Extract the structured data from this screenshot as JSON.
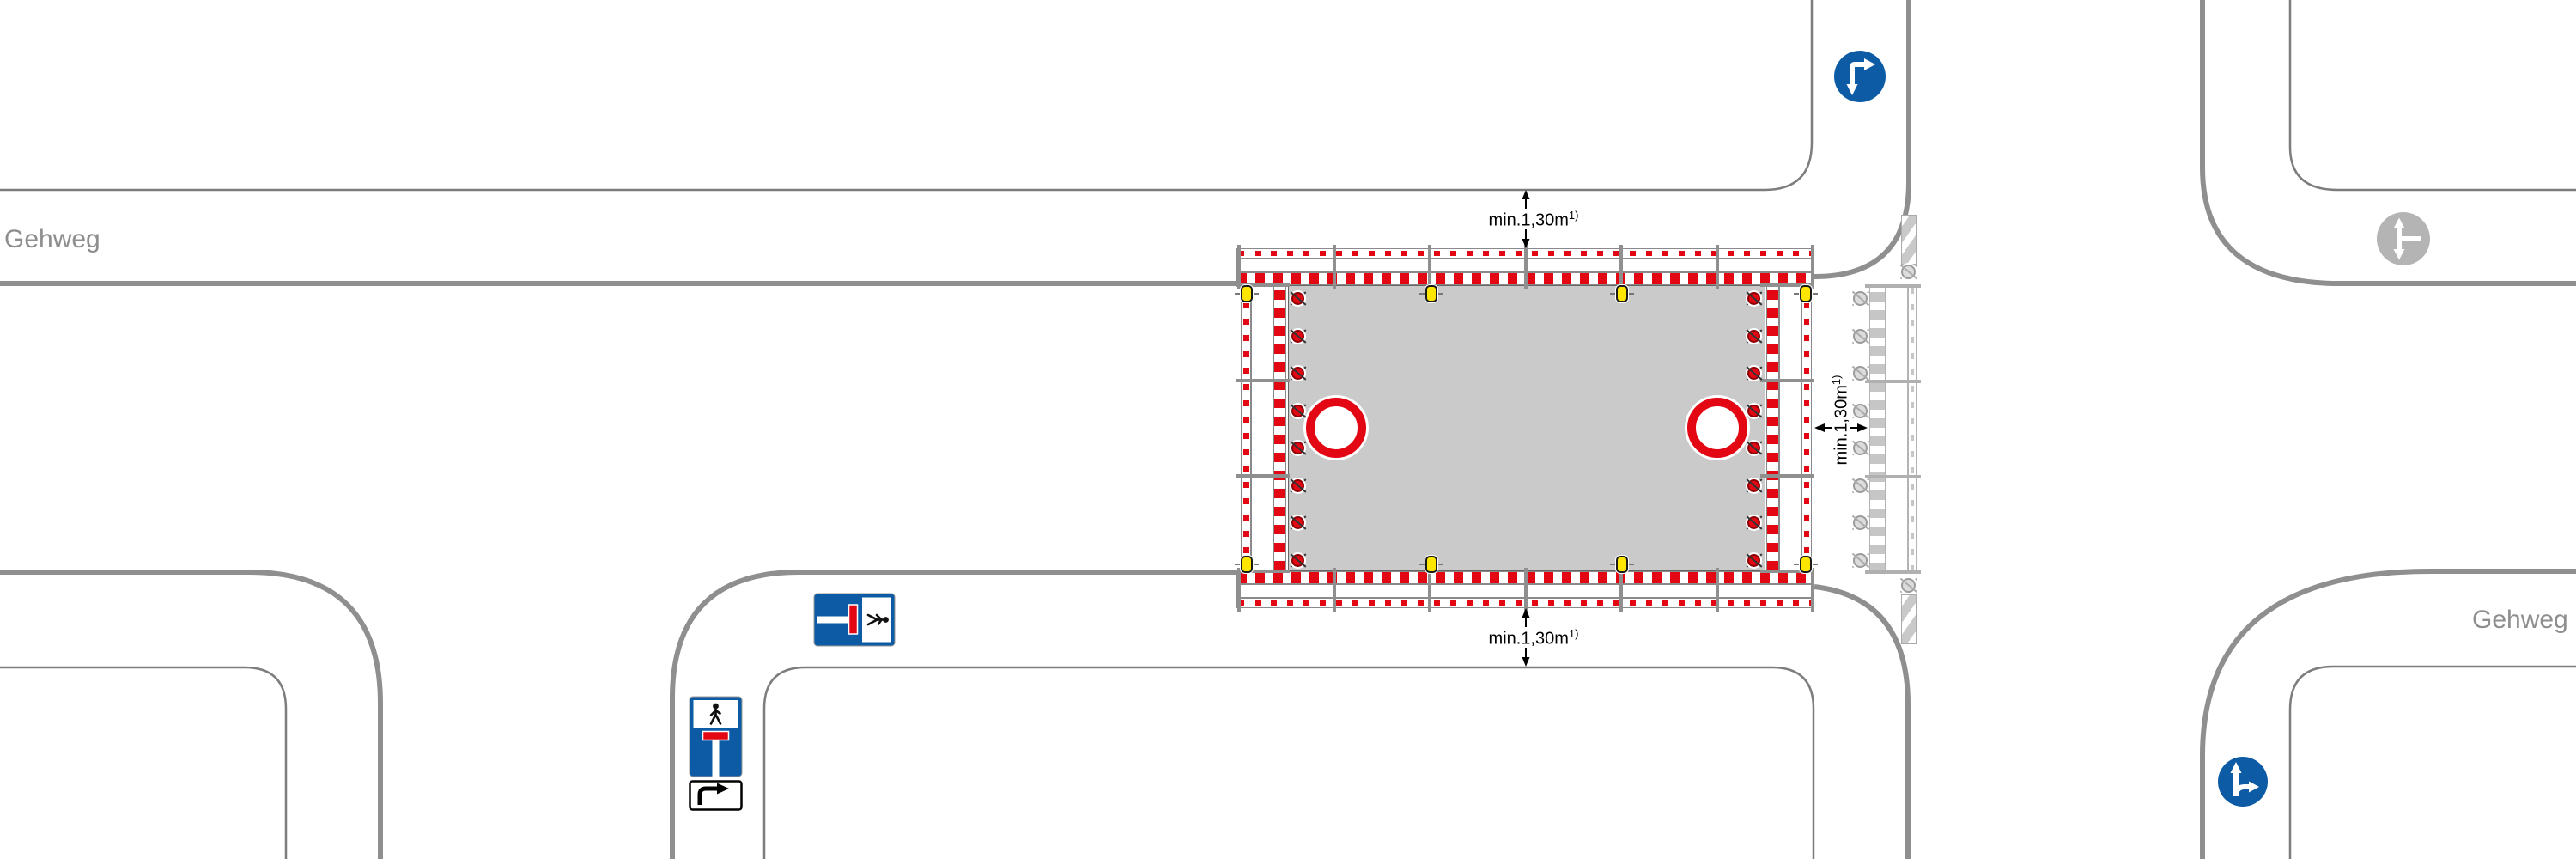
{
  "labels": {
    "gehweg_left": "Gehweg",
    "gehweg_right": "Gehweg"
  },
  "dimensions": {
    "top": {
      "text": "min.1,30m",
      "sup": "1)"
    },
    "bottom": {
      "text": "min.1,30m",
      "sup": "1)"
    },
    "right": {
      "text": "min.1,30m",
      "sup": "1)"
    }
  },
  "icons": {
    "sign_top": "mandatory-direction-down-or-right-icon",
    "sign_bottom_right": "mandatory-direction-straight-or-right-icon",
    "sign_gray_existing": "existing-direction-sign-icon",
    "sign_dead_end_horizontal": "dead-end-pedestrian-passage-icon",
    "sign_dead_end_vertical": "dead-end-pedestrian-passage-icon",
    "supplementary_plate": "right-turn-arrow-plate-icon",
    "red_lamp": "red-warning-lamp-icon",
    "yellow_lamp": "yellow-flashing-lamp-icon",
    "gray_lamp": "inactive-lamp-icon",
    "bake": "hatched-marker-board-icon"
  },
  "colors": {
    "traffic_red": "#e30613",
    "traffic_blue": "#0d5ba5",
    "signal_yellow": "#ffe600",
    "work_area_gray": "#cacaca",
    "curb_gray": "#8f8f8f",
    "faded_gray": "#c6c6c6",
    "label_gray": "#8e8e8e"
  }
}
